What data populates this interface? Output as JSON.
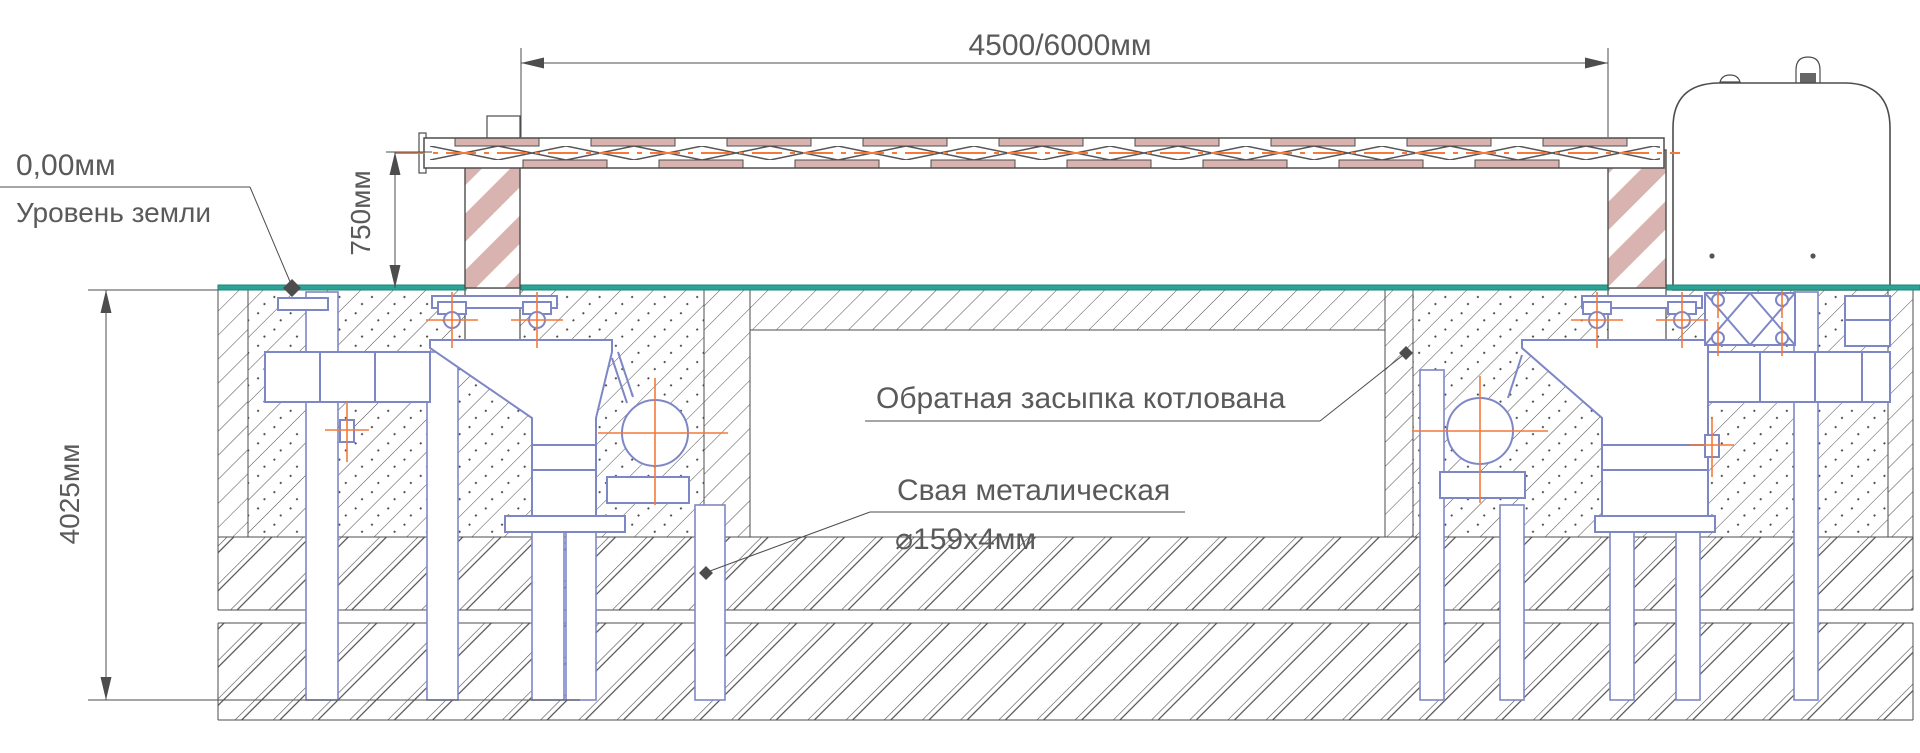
{
  "drawing": {
    "labels": {
      "elevation": "0,00мм",
      "ground_level": "Уровень земли",
      "backfill": "Обратная засыпка котлована",
      "pile_material": "Свая металическая",
      "pile_spec": "⌀159x4мм"
    },
    "dimensions": {
      "opening_width": "4500/6000мм",
      "boom_axis_height": "750мм",
      "foundation_depth": "4025мм"
    },
    "colors": {
      "ground_line": "#2ba395",
      "ground_line_edge": "#1d8578",
      "mechanism_blue": "#7e87c6",
      "stripe_pink": "#d9b3af",
      "centerline_orange": "#f4793b",
      "drawing_line": "#4d4d4d",
      "text_gray": "#5a5a5a"
    }
  }
}
